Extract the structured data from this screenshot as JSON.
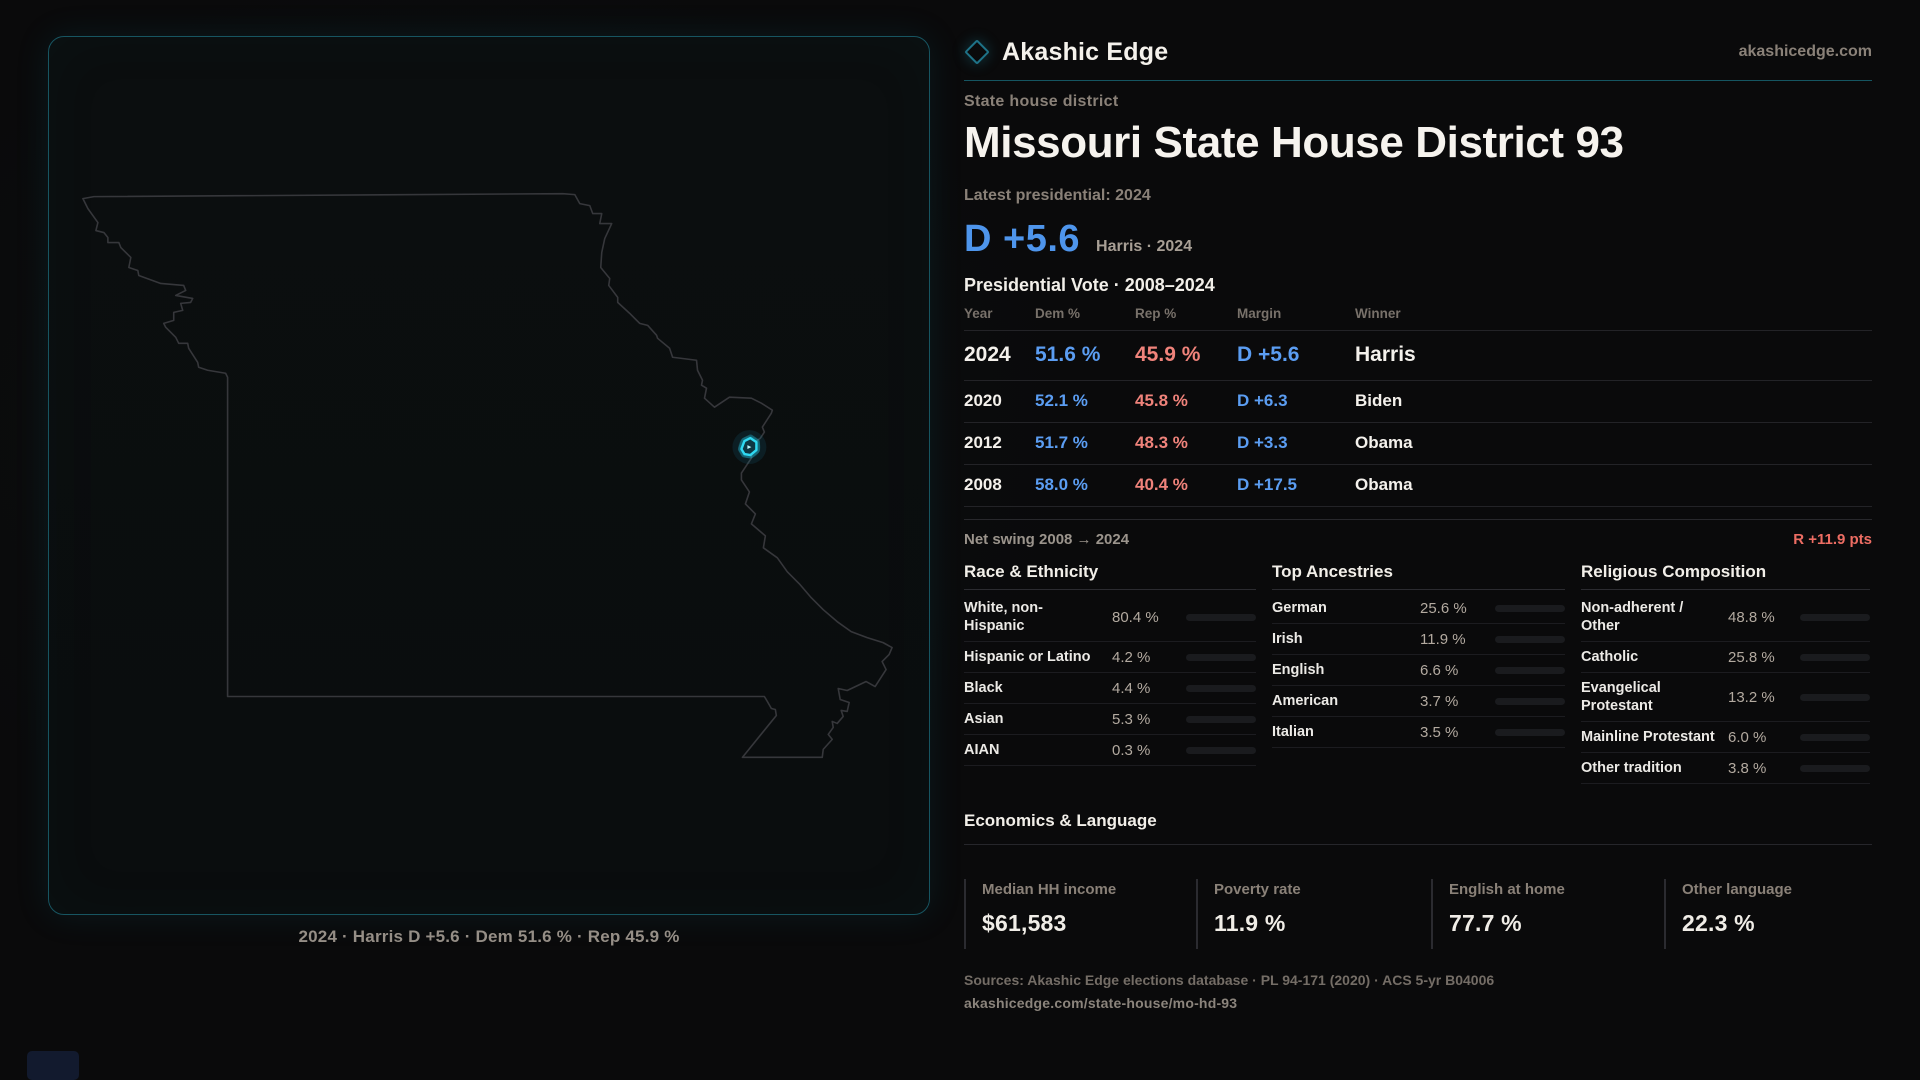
{
  "brand": {
    "logo_icon": "diamond-icon",
    "name": "Akashic Edge",
    "website": "akashicedge.com"
  },
  "page": {
    "kicker": "State house district",
    "title": "Missouri State House District 93",
    "latest_label": "Latest presidential: 2024",
    "headline": {
      "margin": "D +5.6",
      "context": "Harris · 2024"
    }
  },
  "map": {
    "state": "Missouri",
    "marker": "district-93-highlight",
    "marker_color": "#2fd9f2",
    "caption": "2024 · Harris D +5.6 · Dem 51.6 % · Rep 45.9 %"
  },
  "presidential_table": {
    "title": "Presidential Vote · 2008–2024",
    "columns": [
      "Year",
      "Dem %",
      "Rep %",
      "Margin",
      "Winner"
    ],
    "rows": [
      {
        "year": "2024",
        "dem": "51.6 %",
        "rep": "45.9 %",
        "margin": "D +5.6",
        "winner": "Harris",
        "emphasis": true
      },
      {
        "year": "2020",
        "dem": "52.1 %",
        "rep": "45.8 %",
        "margin": "D +6.3",
        "winner": "Biden",
        "emphasis": false
      },
      {
        "year": "2012",
        "dem": "51.7 %",
        "rep": "48.3 %",
        "margin": "D +3.3",
        "winner": "Obama",
        "emphasis": false
      },
      {
        "year": "2008",
        "dem": "58.0 %",
        "rep": "40.4 %",
        "margin": "D +17.5",
        "winner": "Obama",
        "emphasis": false
      }
    ],
    "net_swing": {
      "label": "Net swing 2008 → 2024",
      "value": "R +11.9 pts"
    }
  },
  "demographics": {
    "race": {
      "title": "Race & Ethnicity",
      "scale_max": 100,
      "items": [
        {
          "label": "White, non-Hispanic",
          "value": "80.4 %",
          "pct": 80.4,
          "color": "#9db0c6"
        },
        {
          "label": "Hispanic or Latino",
          "value": "4.2 %",
          "pct": 4.2,
          "color": "#e79b2e"
        },
        {
          "label": "Black",
          "value": "4.4 %",
          "pct": 4.4,
          "color": "#8f7bf0"
        },
        {
          "label": "Asian",
          "value": "5.3 %",
          "pct": 5.3,
          "color": "#2fc690"
        },
        {
          "label": "AIAN",
          "value": "0.3 %",
          "pct": 0.3,
          "color": "#9db0c6"
        }
      ]
    },
    "ancestries": {
      "title": "Top Ancestries",
      "scale_max": 100,
      "items": [
        {
          "label": "German",
          "value": "25.6 %",
          "pct": 25.6,
          "color": "#8fa6c0"
        },
        {
          "label": "Irish",
          "value": "11.9 %",
          "pct": 11.9,
          "color": "#8fa6c0"
        },
        {
          "label": "English",
          "value": "6.6 %",
          "pct": 6.6,
          "color": "#8fa6c0"
        },
        {
          "label": "American",
          "value": "3.7 %",
          "pct": 3.7,
          "color": "#8fa6c0"
        },
        {
          "label": "Italian",
          "value": "3.5 %",
          "pct": 3.5,
          "color": "#8fa6c0"
        }
      ]
    },
    "religion": {
      "title": "Religious Composition",
      "scale_max": 100,
      "items": [
        {
          "label": "Non-adherent / Other",
          "value": "48.8 %",
          "pct": 48.8,
          "color": "#7d8596"
        },
        {
          "label": "Catholic",
          "value": "25.8 %",
          "pct": 25.8,
          "color": "#dfb22f"
        },
        {
          "label": "Evangelical Protestant",
          "value": "13.2 %",
          "pct": 13.2,
          "color": "#df6c63"
        },
        {
          "label": "Mainline Protestant",
          "value": "6.0 %",
          "pct": 6.0,
          "color": "#3f87e8"
        },
        {
          "label": "Other tradition",
          "value": "3.8 %",
          "pct": 3.8,
          "color": "#9aa0a8"
        }
      ]
    }
  },
  "economics": {
    "title": "Economics & Language",
    "stats": [
      {
        "label": "Median HH income",
        "value": "$61,583"
      },
      {
        "label": "Poverty rate",
        "value": "11.9 %"
      },
      {
        "label": "English at home",
        "value": "77.7 %"
      },
      {
        "label": "Other language",
        "value": "22.3 %"
      }
    ]
  },
  "footer": {
    "sources": "Sources: Akashic Edge elections database · PL 94-171 (2020) · ACS 5-yr B04006",
    "permalink": "akashicedge.com/state-house/mo-hd-93"
  },
  "colors": {
    "dem_blue": "#5b9df2",
    "rep_red": "#f0837b",
    "swing_red": "#ed6d63",
    "accent_teal": "#2fd9f2",
    "panel_border_teal": "#175561"
  }
}
